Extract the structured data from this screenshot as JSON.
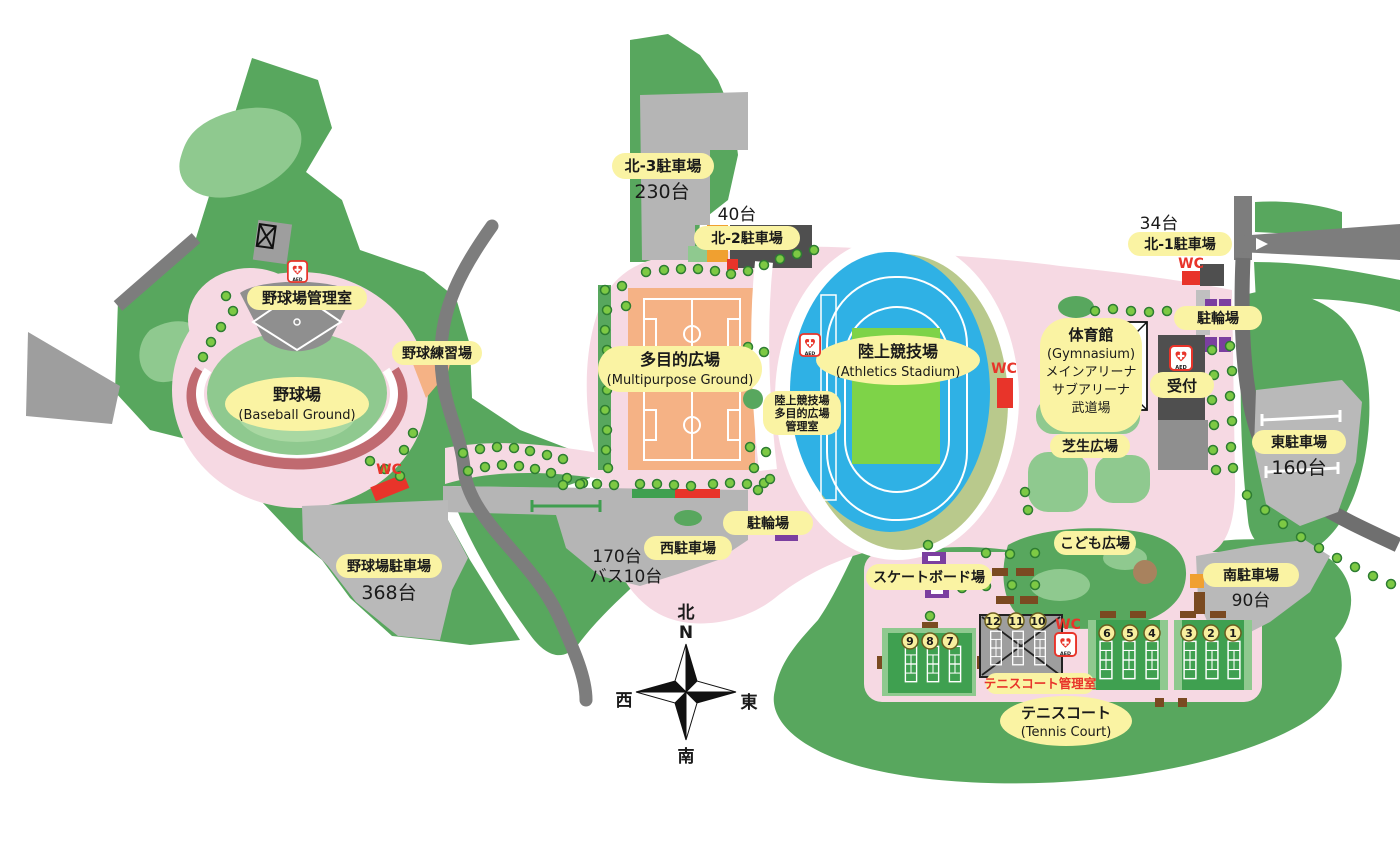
{
  "labels": {
    "baseball_office": "野球場管理室",
    "baseball": {
      "ja": "野球場",
      "en": "(Baseball Ground)"
    },
    "practice": "野球練習場",
    "baseball_parking": {
      "name": "野球場駐車場",
      "count": "368台"
    },
    "north3": {
      "name": "北-3駐車場",
      "count": "230台"
    },
    "north2": {
      "name": "北-2駐車場",
      "count": "40台"
    },
    "north1": {
      "name": "北-1駐車場",
      "count": "34台"
    },
    "multipurpose": {
      "ja": "多目的広場",
      "en": "(Multipurpose Ground)"
    },
    "stadium": {
      "ja": "陸上競技場",
      "en": "(Athletics Stadium)"
    },
    "field_office": {
      "line1": "陸上競技場",
      "line2": "多目的広場",
      "line3": "管理室"
    },
    "gym": {
      "line1": "体育館",
      "line2": "(Gymnasium)",
      "line3": "メインアリーナ",
      "line4": "サブアリーナ",
      "line5": "武道場"
    },
    "reception": "受付",
    "lawn": "芝生広場",
    "east_parking": {
      "name": "東駐車場",
      "count": "160台"
    },
    "bike_center": "駐輪場",
    "bike_east": "駐輪場",
    "west_parking": {
      "name": "西駐車場",
      "count1": "170台",
      "count2": "バス10台"
    },
    "kids": "こども広場",
    "skate": "スケートボード場",
    "south_parking": {
      "name": "南駐車場",
      "count": "90台"
    },
    "tennis_office": "テニスコート管理室",
    "tennis": {
      "ja": "テニスコート",
      "en": "(Tennis Court)"
    }
  },
  "icons": {
    "wc": "WC",
    "aed": "AED"
  },
  "courts": [
    "1",
    "2",
    "3",
    "4",
    "5",
    "6",
    "7",
    "8",
    "9",
    "10",
    "11",
    "12"
  ],
  "compass": {
    "n_ja": "北",
    "n_en": "N",
    "w": "西",
    "e": "東",
    "s": "南"
  },
  "colors": {
    "park_green": "#58a75e",
    "light_green": "#8fc98f",
    "court_green": "#3fa050",
    "path_pink": "#f6d9e3",
    "road_gray": "#7d7d7d",
    "parking_gray": "#b9b9b9",
    "track_blue": "#2fb1e5",
    "infield_green": "#7ed348",
    "ground_orange": "#f5b285",
    "label_yellow": "#faf3a3",
    "marker_purple": "#7b3fa0",
    "alert_red": "#e8342a",
    "tree_green": "#7dc944",
    "stand_gray": "#8f8f8f",
    "khaki": "#b9c98c"
  }
}
